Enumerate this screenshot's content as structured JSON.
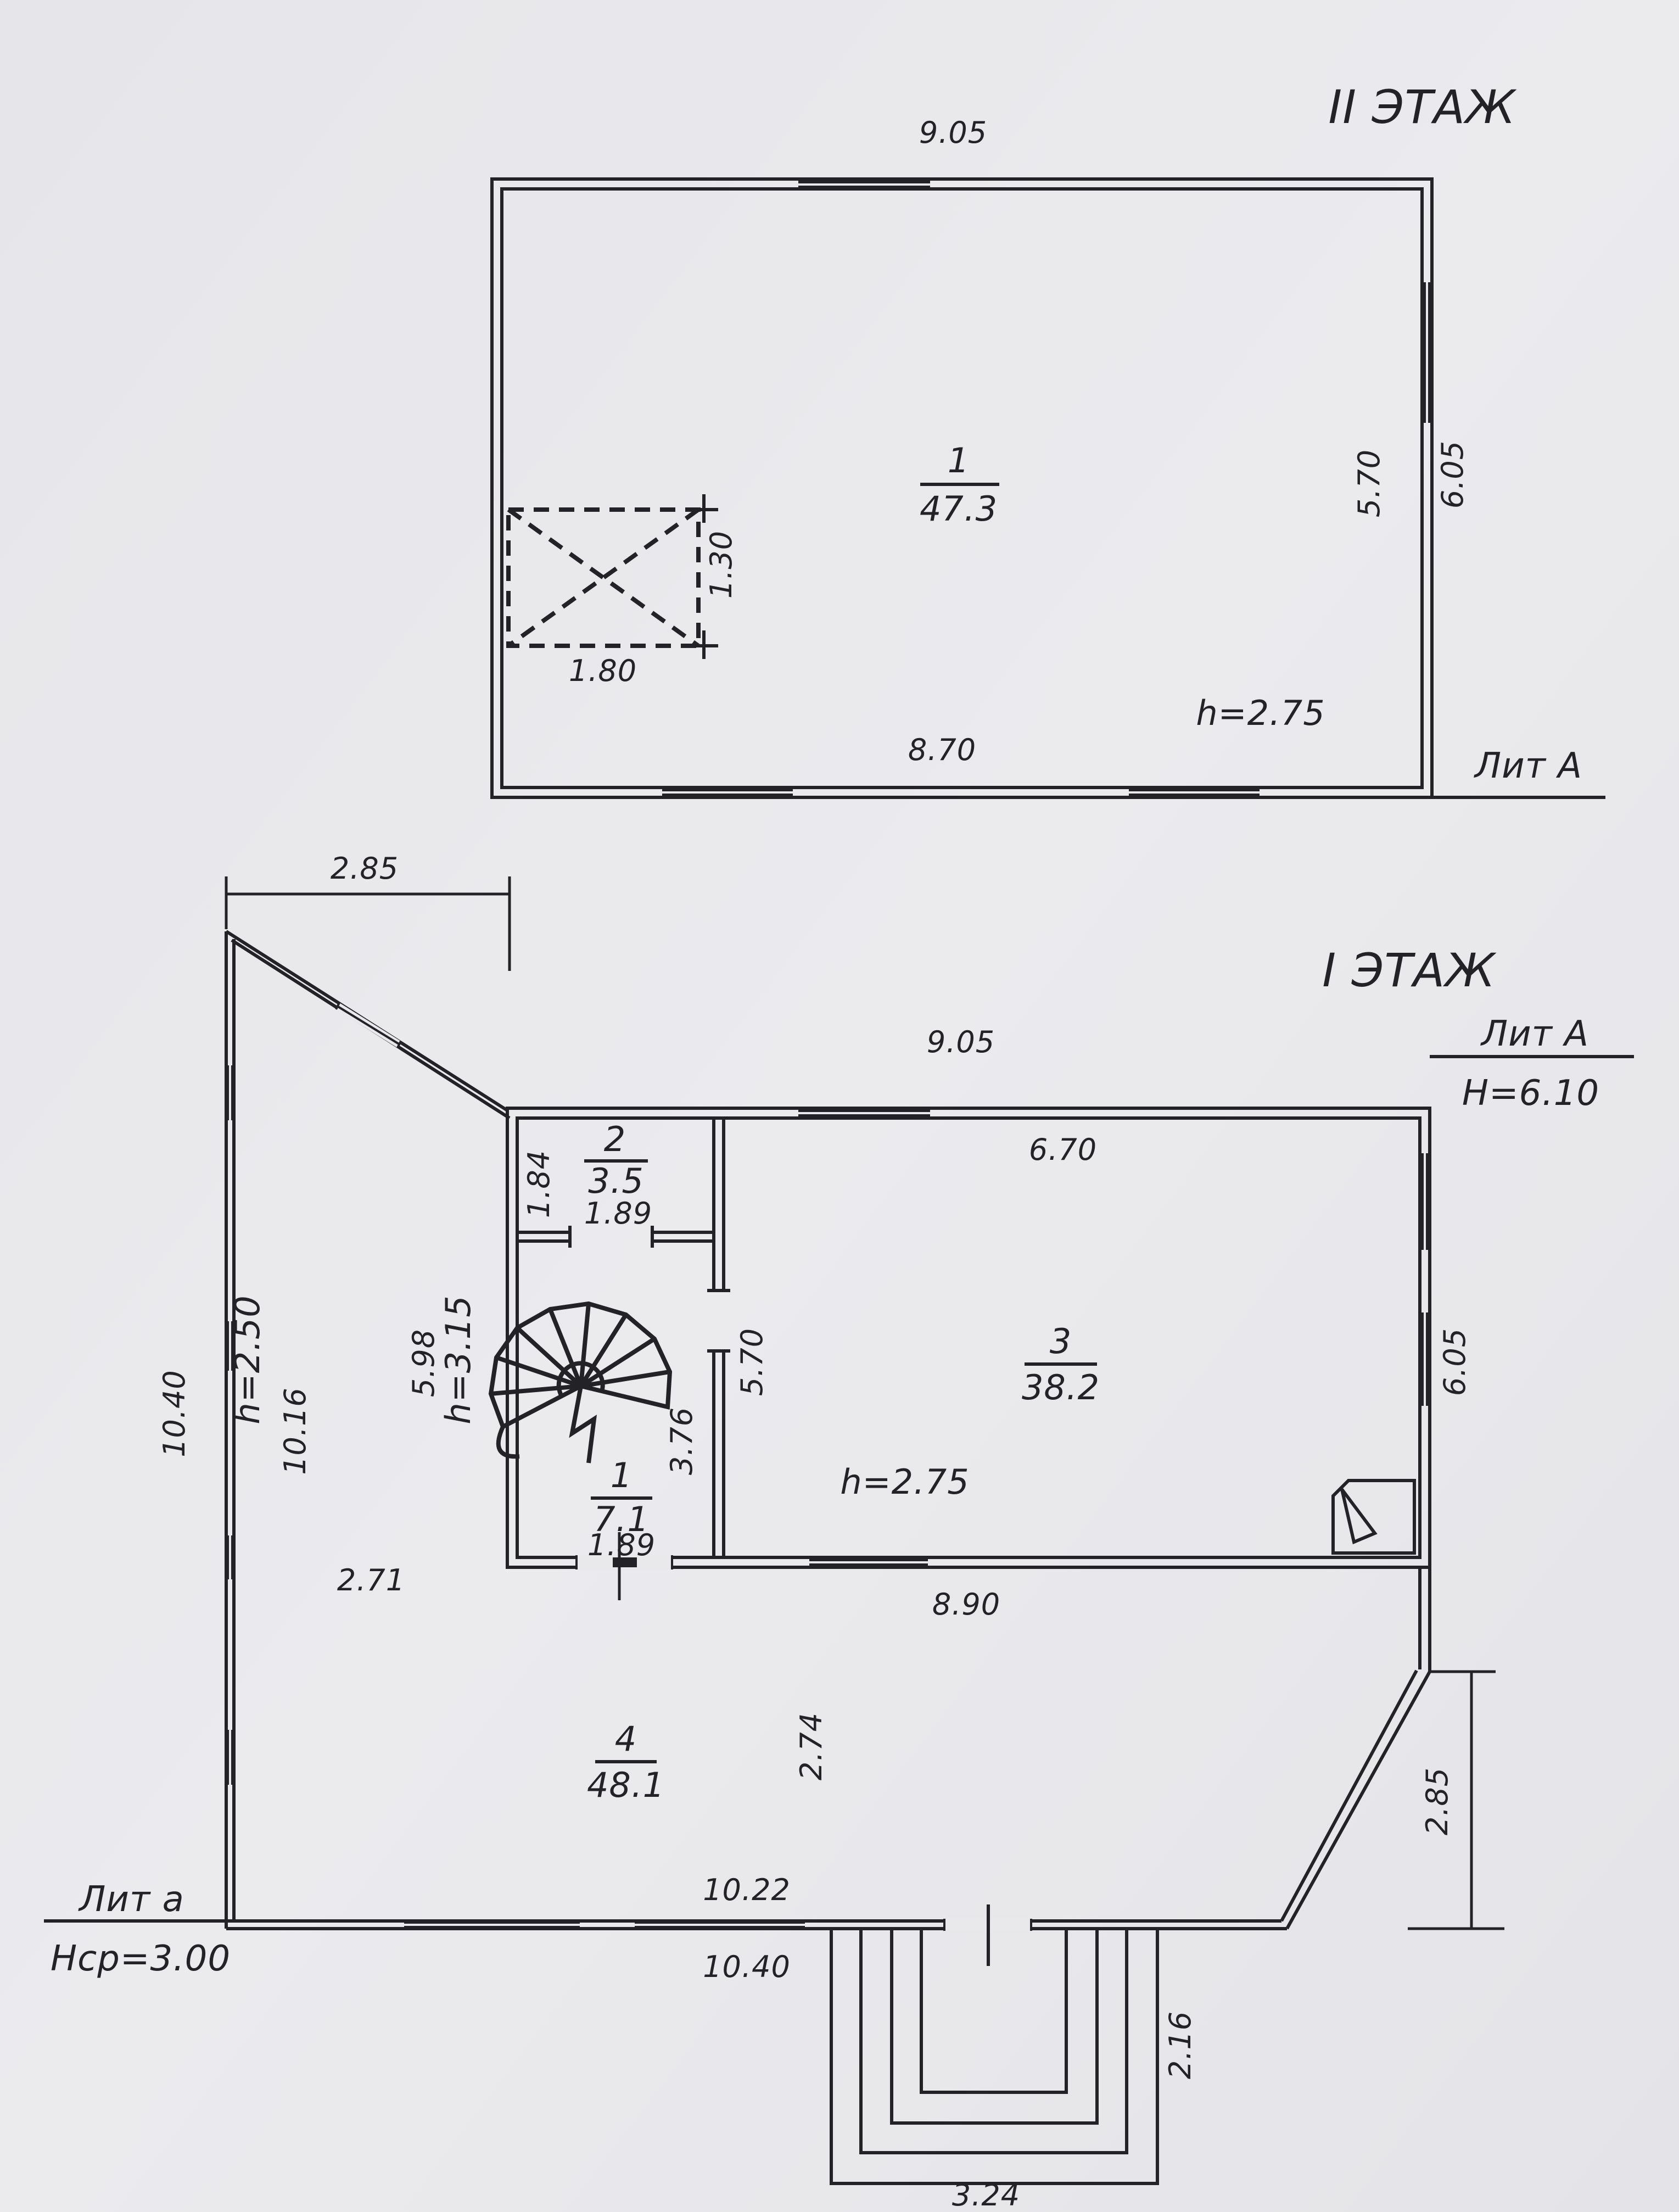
{
  "colors": {
    "paper": "#e9e9ec",
    "paper_light": "#f0f0f2",
    "ink": "#232327"
  },
  "floor2": {
    "title": "II ЭТАЖ",
    "litera": "Лит А",
    "room1": {
      "number": "1",
      "area": "47.3",
      "ceiling": "h=2.75"
    },
    "dims": {
      "width_top": "9.05",
      "width_bottom_inner": "8.70",
      "height_right_inner": "5.70",
      "height_right_outer": "6.05",
      "opening_width": "1.80",
      "opening_height": "1.30"
    }
  },
  "floor1": {
    "title": "I ЭТАЖ",
    "litera": "Лит А",
    "total_height": "Н=6.10",
    "dims": {
      "width_top": "9.05",
      "roof_offset": "2.85",
      "room3_width_top": "6.70",
      "room3_height_side": "5.70",
      "stair_wall": "3.76",
      "house_west_side": "5.98",
      "width_bottom_inner": "8.90",
      "chamfer_height": "2.85",
      "height_right_outer": "6.05"
    },
    "room2": {
      "number": "2",
      "area": "3.5",
      "depth": "1.84",
      "width": "1.89"
    },
    "room1": {
      "number": "1",
      "area": "7.1",
      "width": "1.89"
    },
    "room3": {
      "number": "3",
      "area": "38.2",
      "ceiling": "h=2.75"
    },
    "room4": {
      "number": "4",
      "area": "48.1",
      "depth": "2.74"
    }
  },
  "annex": {
    "litera": "Лит а",
    "avg_height": "Нср=3.00",
    "height_low": "h=2.50",
    "height_high": "h=3.15",
    "dims": {
      "west_outer": "10.40",
      "west_inner": "10.16",
      "width_left": "2.71",
      "bottom_inner": "10.22",
      "bottom_outer": "10.40"
    }
  },
  "porch": {
    "width": "3.24",
    "depth": "2.16"
  }
}
